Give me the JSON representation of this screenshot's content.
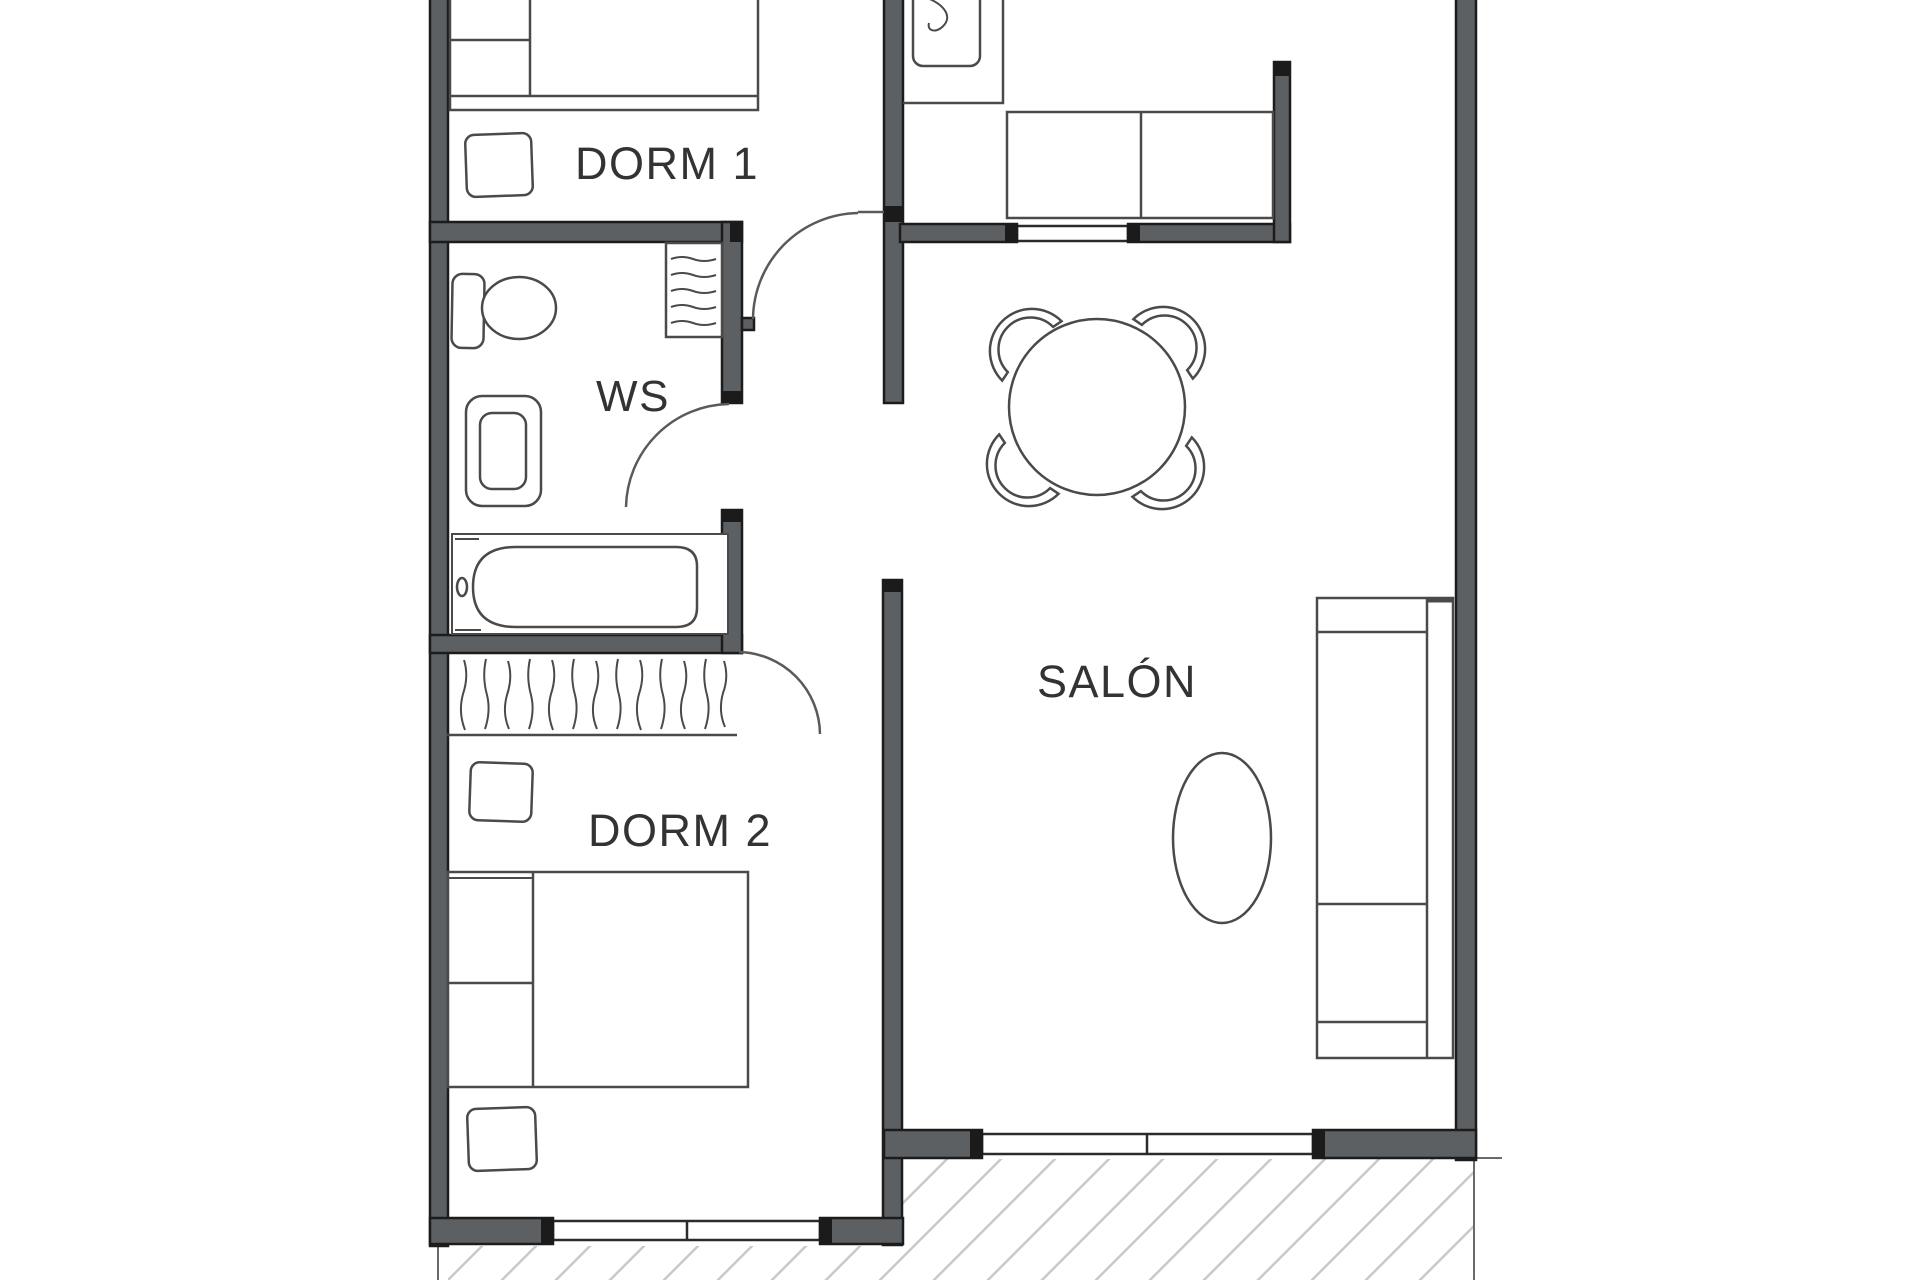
{
  "title": "Apartment floor plan",
  "rooms": {
    "dorm1": {
      "label": "DORM 1"
    },
    "ws": {
      "label": "WS"
    },
    "dorm2": {
      "label": "DORM 2"
    },
    "salon": {
      "label": "SALÓN"
    }
  },
  "colors": {
    "background": "#ffffff",
    "wall_fill": "#5d6063",
    "wall_edge": "#1c1c1c",
    "furniture_line": "#4a4a4a",
    "door_arc": "#5a5a5a",
    "hatch": "#c9c9c9",
    "label_text": "#333333"
  },
  "icons": [
    "double-bed-icon",
    "nightstand-icon",
    "fridge-icon",
    "kitchen-counter-icon",
    "dining-table-icon",
    "dining-chair-icon",
    "toilet-icon",
    "sink-icon",
    "towel-radiator-icon",
    "bathtub-icon",
    "wardrobe-icon",
    "sofa-icon",
    "coffee-table-icon",
    "window-icon",
    "door-swing-icon",
    "terrace-hatch-icon"
  ]
}
